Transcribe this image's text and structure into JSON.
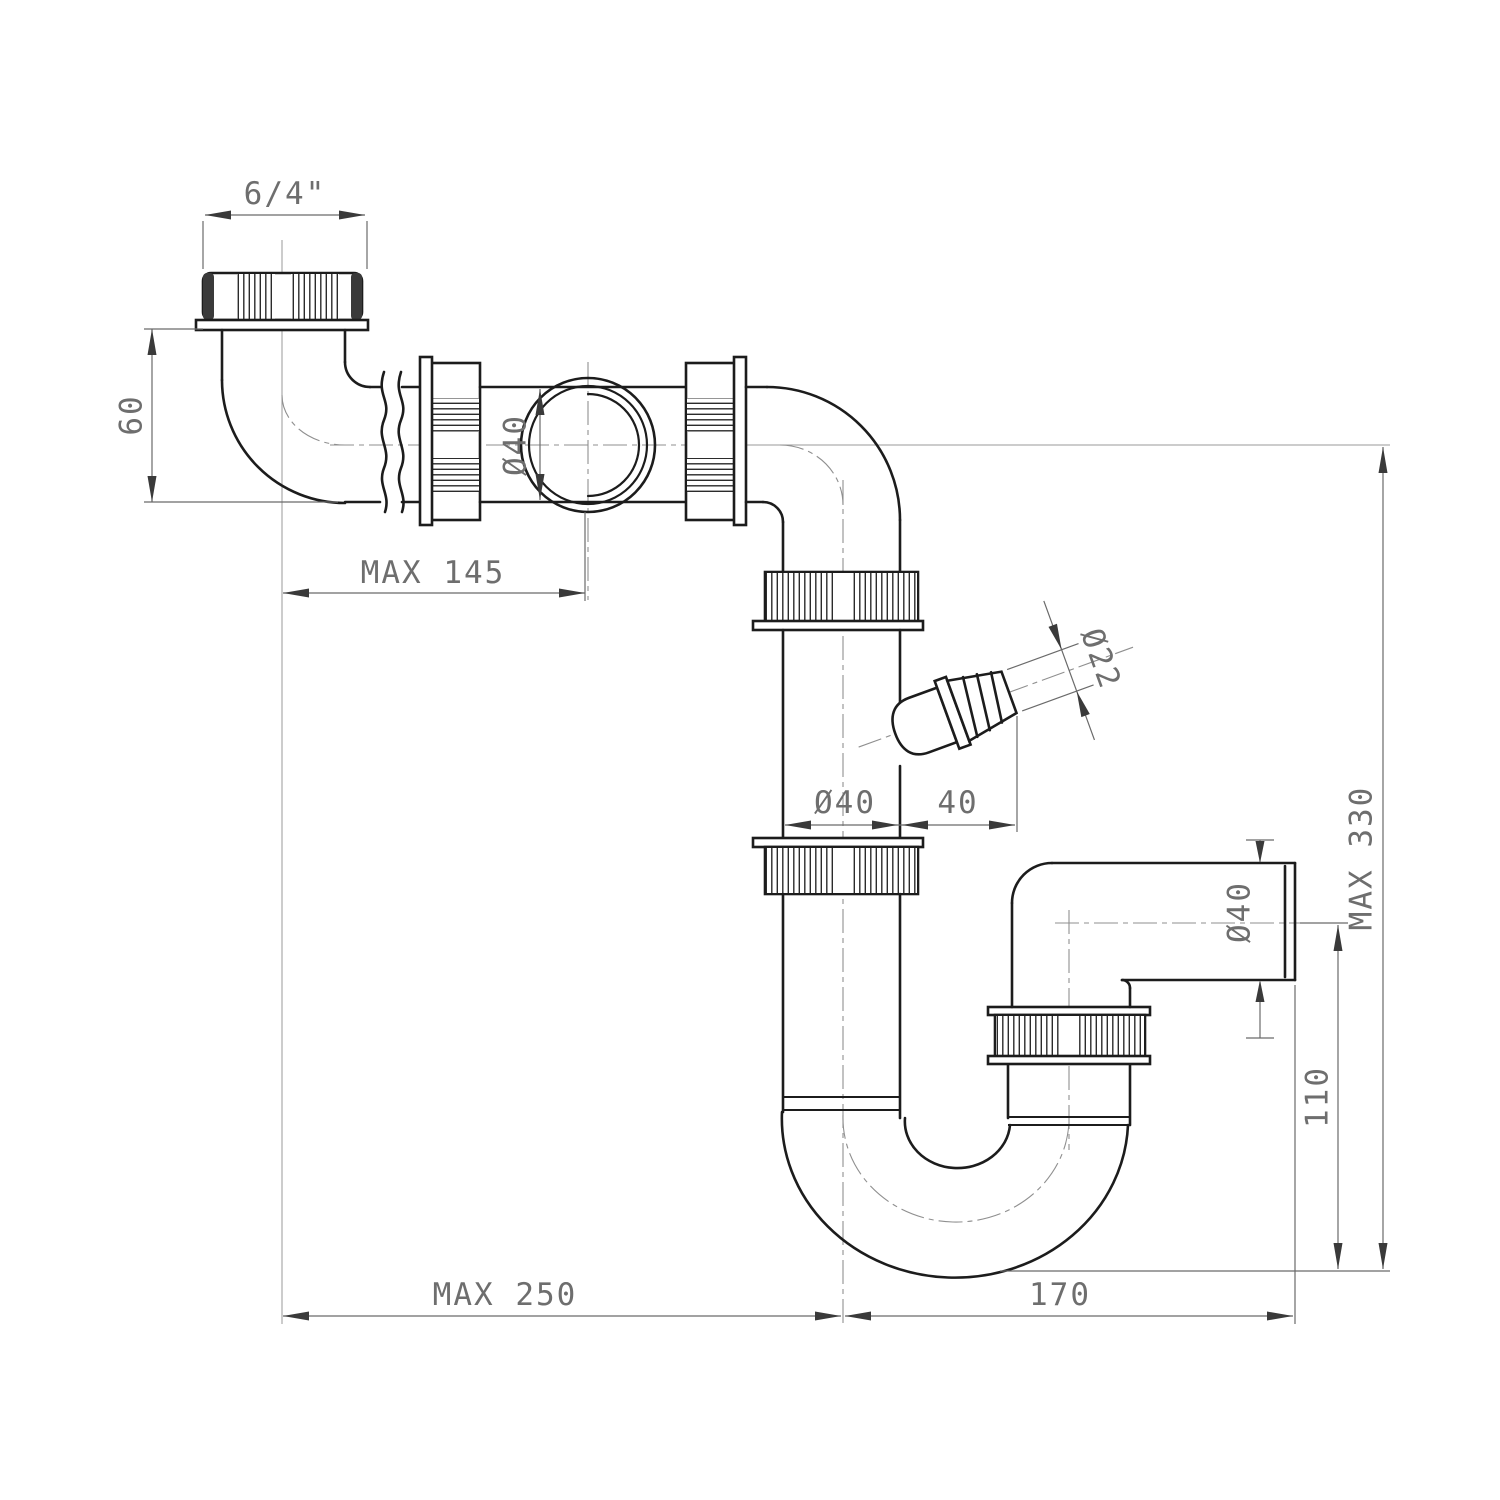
{
  "drawing": {
    "kind": "technical-dimension-drawing",
    "subject": "sink-siphon-trap-with-washing-machine-connection",
    "background_color": "#ffffff",
    "outline_color": "#1c1c1c",
    "dimension_color": "#6e6e6e"
  },
  "dimensions": {
    "thread_size": "6/4\"",
    "inlet_drop": "60",
    "horizontal_reach": "MAX 145",
    "pipe_bore": "Ø40",
    "standpipe_bore": "Ø40",
    "barb_offset": "40",
    "barb_bore": "Ø22",
    "overall_height": "MAX 330",
    "outlet_bore": "Ø40",
    "outlet_drop": "110",
    "horizontal_span": "MAX 250",
    "trap_offset": "170"
  }
}
